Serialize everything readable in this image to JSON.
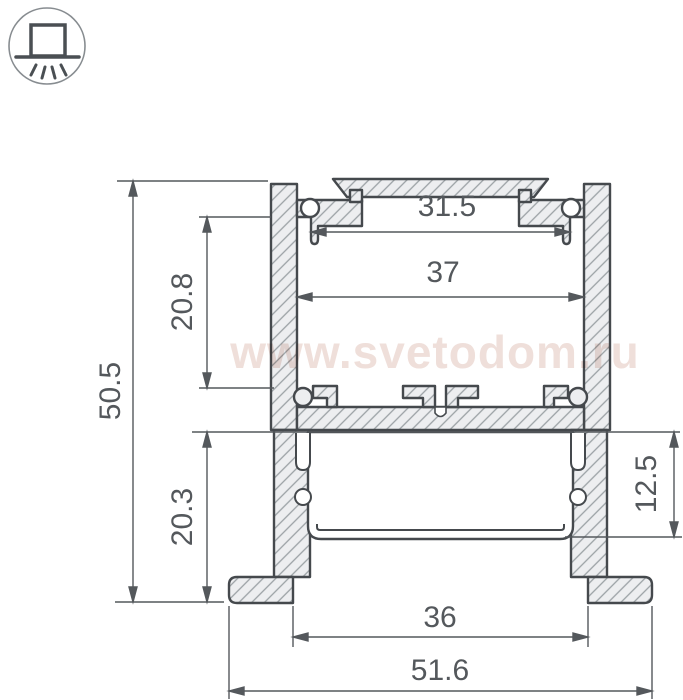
{
  "watermark": "www.svetodom.ru",
  "icon": {
    "name": "surface-mount-downlight"
  },
  "drawing": {
    "type": "aluminium LED profile cross-section",
    "units": "mm"
  },
  "dims": {
    "slot_width": {
      "label": "31.5"
    },
    "inner_width": {
      "label": "37"
    },
    "upper_height": {
      "label": "20.8"
    },
    "total_height": {
      "label": "50.5"
    },
    "lower_height": {
      "label": "20.3"
    },
    "diffuser_height": {
      "label": "12.5"
    },
    "feet_gap": {
      "label": "36"
    },
    "total_width": {
      "label": "51.6"
    }
  },
  "colors": {
    "profile_line": "#45494d",
    "dimension": "#54585c",
    "hatch": "#9ba1a5",
    "metal_fill": "#edeef0",
    "watermark": "#efdfda",
    "icon_ring": "#878c90"
  }
}
